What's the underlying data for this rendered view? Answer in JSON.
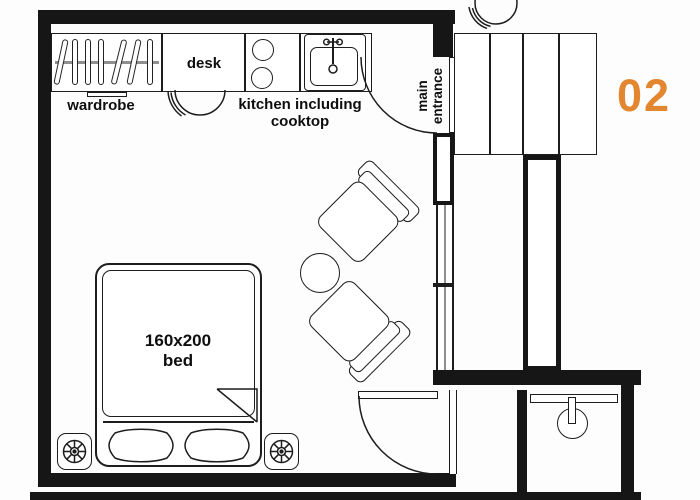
{
  "unit": {
    "number": "02"
  },
  "labels": {
    "wardrobe": "wardrobe",
    "desk": "desk",
    "kitchen_line1": "kitchen including",
    "kitchen_line2": "cooktop",
    "entrance_line1": "main",
    "entrance_line2": "entrance",
    "bed_size": "160x200",
    "bed": "bed"
  },
  "colors": {
    "wall": "#161616",
    "line": "#1d1d1d",
    "accent_orange": "#e2862f",
    "window_gray": "#8f8f8f"
  },
  "furniture": [
    "wardrobe",
    "desk",
    "desk-chair",
    "cooktop-burners",
    "kitchen-sink",
    "armchair-upper",
    "armchair-lower",
    "side-table",
    "double-bed",
    "pillows",
    "nightstand-left",
    "nightstand-right",
    "corridor-cabinet",
    "corner-chair",
    "shower-fixture"
  ]
}
